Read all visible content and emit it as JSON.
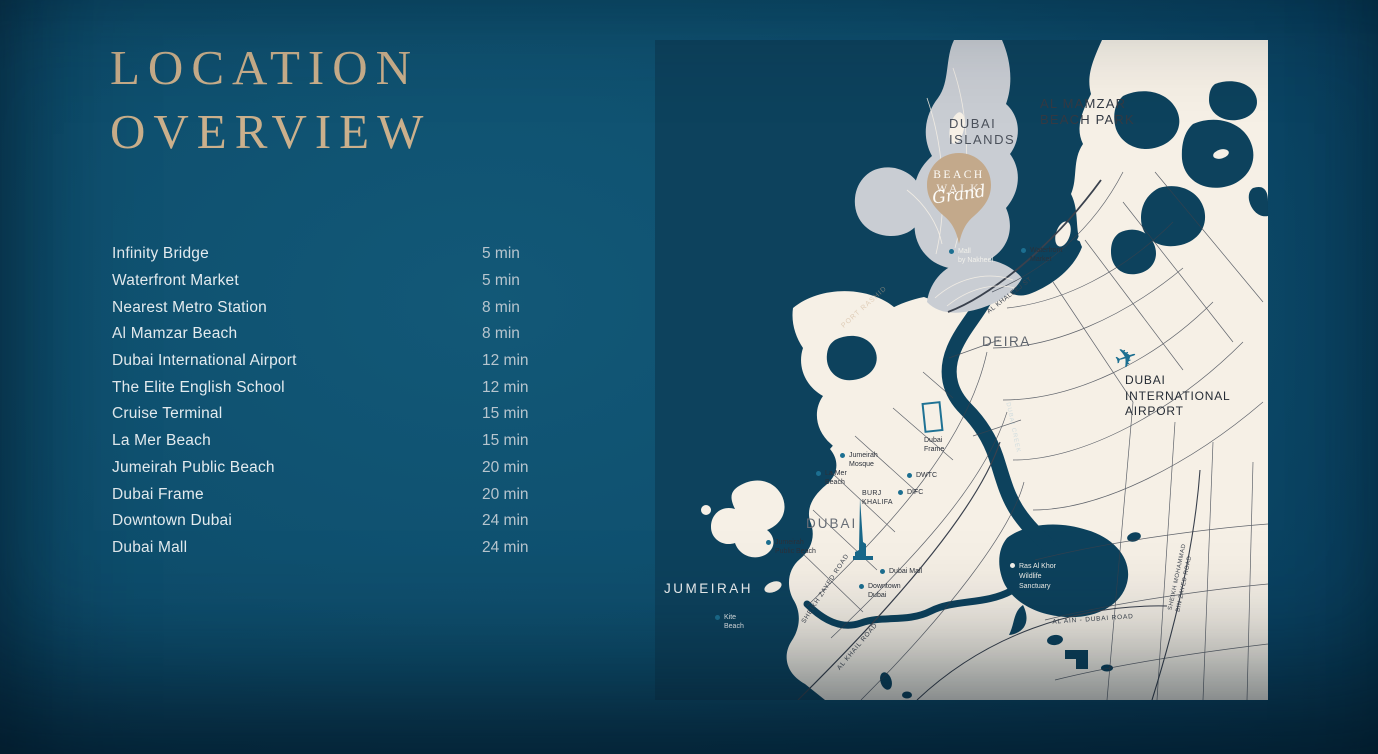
{
  "title": {
    "line1": "LOCATION",
    "line2": "OVERVIEW"
  },
  "distances": [
    {
      "name": "Infinity Bridge",
      "time": "5 min"
    },
    {
      "name": "Waterfront Market",
      "time": "5 min"
    },
    {
      "name": "Nearest Metro Station",
      "time": "8 min"
    },
    {
      "name": "Al Mamzar Beach",
      "time": "8 min"
    },
    {
      "name": "Dubai International Airport",
      "time": "12 min"
    },
    {
      "name": "The Elite English School",
      "time": "12 min"
    },
    {
      "name": "Cruise Terminal",
      "time": "15 min"
    },
    {
      "name": "La Mer Beach",
      "time": "15 min"
    },
    {
      "name": "Jumeirah Public Beach",
      "time": "20 min"
    },
    {
      "name": "Dubai Frame",
      "time": "20 min"
    },
    {
      "name": "Downtown Dubai",
      "time": "24 min"
    },
    {
      "name": "Dubai Mall",
      "time": "24 min"
    }
  ],
  "colors": {
    "background": "#0f4f6b",
    "accent_gold": "#cbb08c",
    "map_cream": "#f6f0e6",
    "map_water": "#0d425d",
    "map_grey": "#c9cdd3",
    "poi_teal": "#1c6f91",
    "pin_tan": "#c3a98b"
  },
  "map": {
    "pin": {
      "line1": "BEACH",
      "line2": "WALK",
      "script": "Grand"
    },
    "icons": [
      {
        "id": "airplane-icon"
      },
      {
        "id": "dubai-frame-icon"
      },
      {
        "id": "burj-khalifa-icon"
      }
    ],
    "labels": [
      {
        "id": "dubai-islands",
        "lines": [
          "DUBAI",
          "ISLANDS"
        ],
        "x": 294,
        "y": 76,
        "size": 13,
        "color": "#4b515b",
        "ls": 1.5
      },
      {
        "id": "al-mamzar-beach-park",
        "lines": [
          "AL MAMZAR",
          "BEACH PARK"
        ],
        "x": 385,
        "y": 56,
        "size": 13,
        "color": "#343a44",
        "ls": 1.2
      },
      {
        "id": "deira",
        "lines": [
          "DEIRA"
        ],
        "x": 327,
        "y": 294,
        "size": 13.5,
        "color": "#5d636c",
        "ls": 1.5
      },
      {
        "id": "dubai-intl-airport",
        "lines": [
          "DUBAI",
          "INTERNATIONAL",
          "AIRPORT"
        ],
        "x": 470,
        "y": 333,
        "size": 12,
        "color": "#262c35",
        "ls": 0.8,
        "lh": 1.3
      },
      {
        "id": "dubai-city",
        "lines": [
          "DUBAI"
        ],
        "x": 151,
        "y": 476,
        "size": 13.5,
        "color": "#676d76",
        "ls": 2
      },
      {
        "id": "jumeirah-region",
        "lines": [
          "JUMEIRAH"
        ],
        "x": 9,
        "y": 541,
        "size": 13.5,
        "color": "#eef1f2",
        "ls": 2.5
      },
      {
        "id": "mall-by-nakheel",
        "lines": [
          "Mall",
          "by Nakheel"
        ],
        "x": 294,
        "y": 208,
        "size": 7,
        "color": "#f2f1ec",
        "dot": "#1c6f91"
      },
      {
        "id": "waterfront-market",
        "lines": [
          "Waterfront",
          "Market"
        ],
        "x": 366,
        "y": 207,
        "size": 7,
        "color": "#2b313b",
        "dot": "#1c6f91"
      },
      {
        "id": "al-khaleej-st",
        "lines": [
          "AL KHALEEJ ST"
        ],
        "x": 355,
        "y": 256,
        "size": 6.5,
        "color": "#3c434e",
        "rot": -38,
        "anchor": "center",
        "ls": 0.5
      },
      {
        "id": "port-rashid-watermark",
        "lines": [
          "PORT RASHID"
        ],
        "x": 210,
        "y": 268,
        "size": 7,
        "color": "rgba(203,174,142,0.5)",
        "rot": -42,
        "anchor": "center",
        "ls": 1
      },
      {
        "id": "dubai-creek-watermark",
        "lines": [
          "DUBAI CREEK"
        ],
        "x": 357,
        "y": 388,
        "size": 6,
        "color": "rgba(160,195,212,0.45)",
        "rot": 78,
        "anchor": "center",
        "ls": 1
      },
      {
        "id": "dubai-frame",
        "lines": [
          "Dubai",
          "Frame"
        ],
        "x": 269,
        "y": 397,
        "size": 7,
        "color": "#2b313b"
      },
      {
        "id": "jumeirah-mosque",
        "lines": [
          "Jumeirah",
          "Mosque"
        ],
        "x": 185,
        "y": 412,
        "size": 7,
        "color": "#2b313b",
        "dot": "#1c6f91"
      },
      {
        "id": "la-mer-beach",
        "lines": [
          "La Mer",
          "Beach"
        ],
        "x": 161,
        "y": 430,
        "size": 7,
        "color": "#2b313b",
        "dot": "#1c6f91"
      },
      {
        "id": "dwtc",
        "lines": [
          "DWTC"
        ],
        "x": 252,
        "y": 432,
        "size": 7,
        "color": "#2b313b",
        "dot": "#1c6f91"
      },
      {
        "id": "difc",
        "lines": [
          "DIFC"
        ],
        "x": 243,
        "y": 449,
        "size": 7,
        "color": "#2b313b",
        "dot": "#1c6f91"
      },
      {
        "id": "burj-khalifa",
        "lines": [
          "BURJ",
          "KHALIFA"
        ],
        "x": 207,
        "y": 450,
        "size": 7,
        "color": "#2b313b",
        "ls": 0.3
      },
      {
        "id": "dubai-mall",
        "lines": [
          "Dubai Mall"
        ],
        "x": 225,
        "y": 528,
        "size": 7,
        "color": "#2b313b",
        "dot": "#1c6f91"
      },
      {
        "id": "downtown-dubai",
        "lines": [
          "Downtown",
          "Dubai"
        ],
        "x": 204,
        "y": 543,
        "size": 7,
        "color": "#2b313b",
        "dot": "#1c6f91"
      },
      {
        "id": "jumeirah-public-beach",
        "lines": [
          "Jumeirah",
          "Public Beach"
        ],
        "x": 111,
        "y": 499,
        "size": 7,
        "color": "#2b313b",
        "dot": "#1c6f91"
      },
      {
        "id": "kite-beach",
        "lines": [
          "Kite",
          "Beach"
        ],
        "x": 60,
        "y": 574,
        "size": 7,
        "color": "#e8ecee",
        "dot": "#1c6f91"
      },
      {
        "id": "ras-al-khor",
        "lines": [
          "Ras Al Khor",
          "Wildlife",
          "Sanctuary"
        ],
        "x": 355,
        "y": 522,
        "size": 7,
        "color": "#f2f1ec",
        "dot": "#f2f1ec",
        "lh": 1.45
      },
      {
        "id": "al-ain-dubai-road",
        "lines": [
          "AL AIN - DUBAI ROAD"
        ],
        "x": 438,
        "y": 580,
        "size": 6.5,
        "color": "#3c434e",
        "rot": -4,
        "anchor": "center",
        "ls": 0.8
      },
      {
        "id": "sheikh-zayed-road",
        "lines": [
          "SHEIKH ZAYED ROAD"
        ],
        "x": 171,
        "y": 549,
        "size": 6.5,
        "color": "#3c434e",
        "rot": -57,
        "anchor": "center",
        "ls": 0.8
      },
      {
        "id": "al-khail-road",
        "lines": [
          "AL KHAIL ROAD"
        ],
        "x": 203,
        "y": 607,
        "size": 6.5,
        "color": "#3c434e",
        "rot": -50,
        "anchor": "center",
        "ls": 0.8
      },
      {
        "id": "sheikh-mohammad-bin-zayed-road",
        "lines": [
          "SHEIKH MOHAMMAD",
          "BIN ZAYED ROAD"
        ],
        "x": 527,
        "y": 538,
        "size": 6,
        "color": "#3c434e",
        "rot": -78,
        "anchor": "center",
        "ls": 0.5
      }
    ]
  }
}
